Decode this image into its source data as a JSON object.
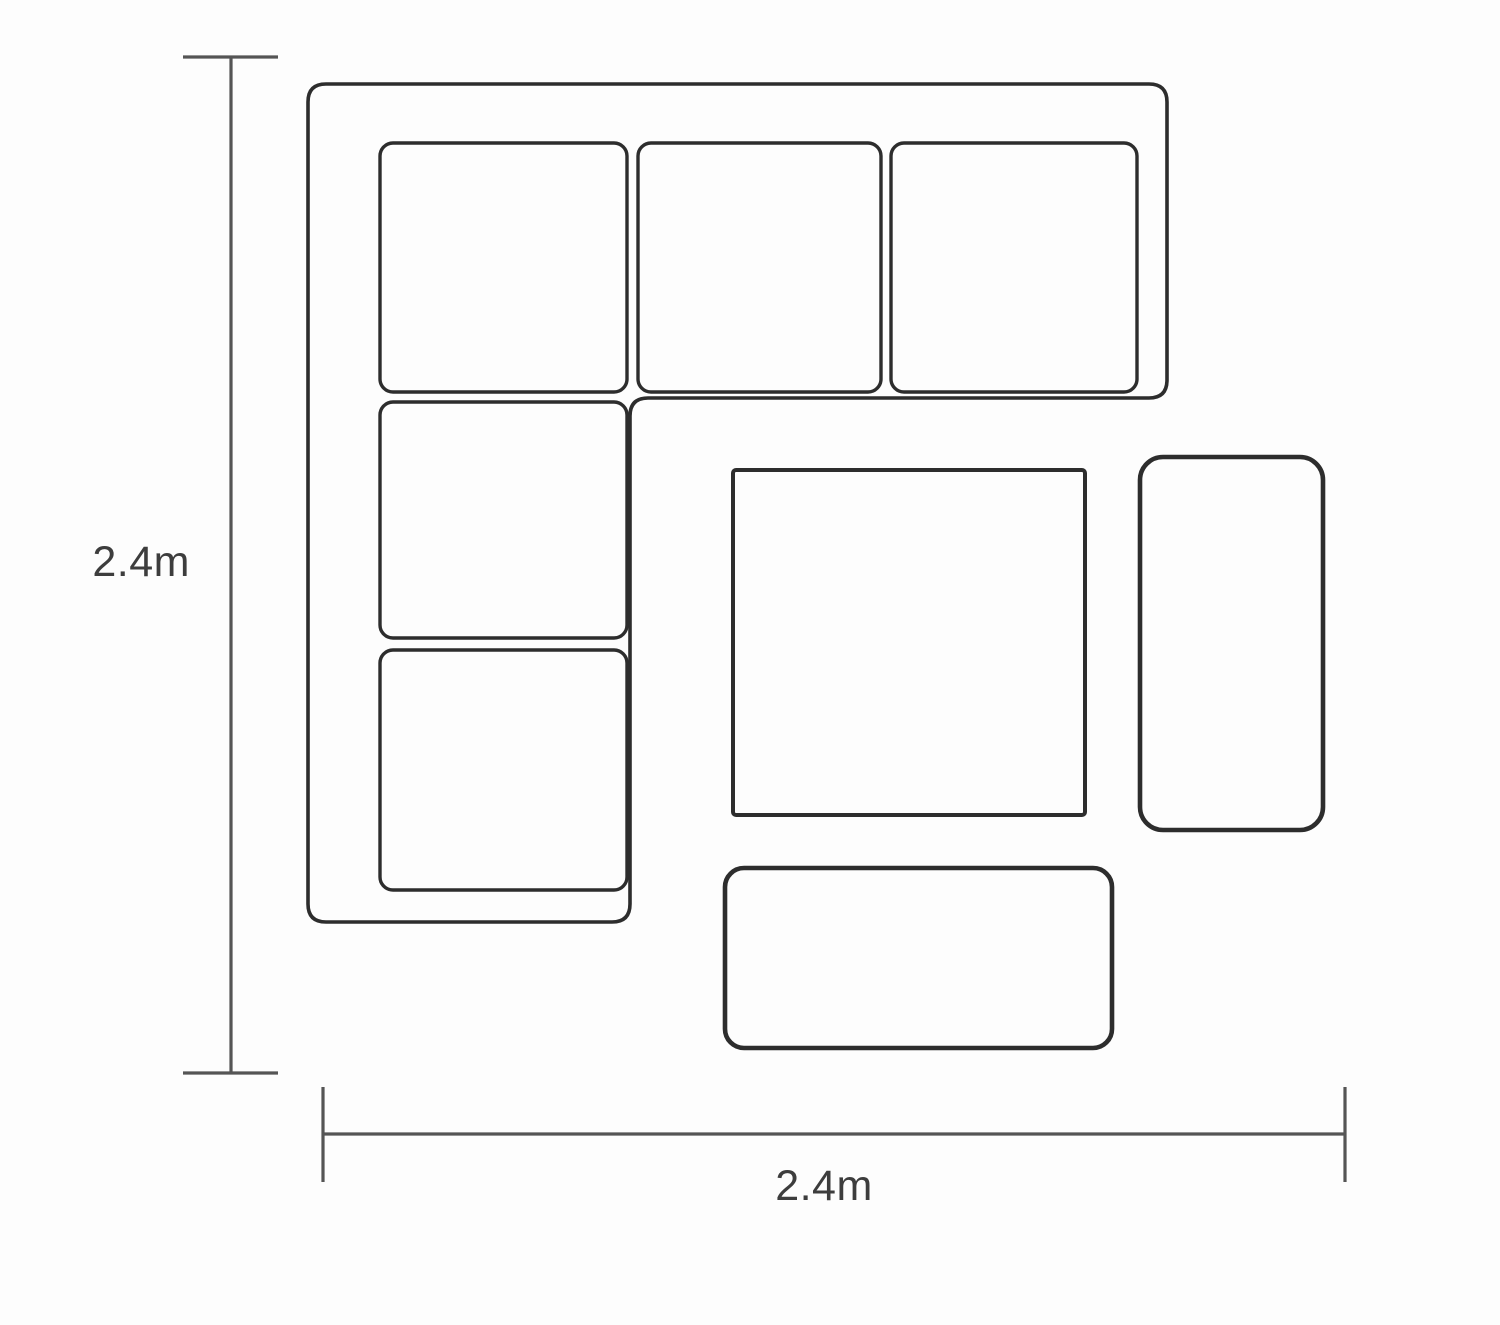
{
  "diagram": {
    "type": "furniture-floor-plan",
    "description_semantic": "corner-sofa-set-top-view-dimension-diagram"
  },
  "dimensions": {
    "vertical": {
      "label": "2.4m"
    },
    "horizontal": {
      "label": "2.4m"
    }
  },
  "components": {
    "sofa_outline": "l-shaped-corner-sofa",
    "cushion_count": 4,
    "corner_cushion_count": 1,
    "table": "square-table",
    "side_bench": "right-bench-stool",
    "front_bench": "bottom-bench-stool"
  },
  "colors": {
    "bg": "#fdfdfd",
    "furniture": "#2d2d2d",
    "dimension": "#555555",
    "label": "#3d3d3d"
  }
}
